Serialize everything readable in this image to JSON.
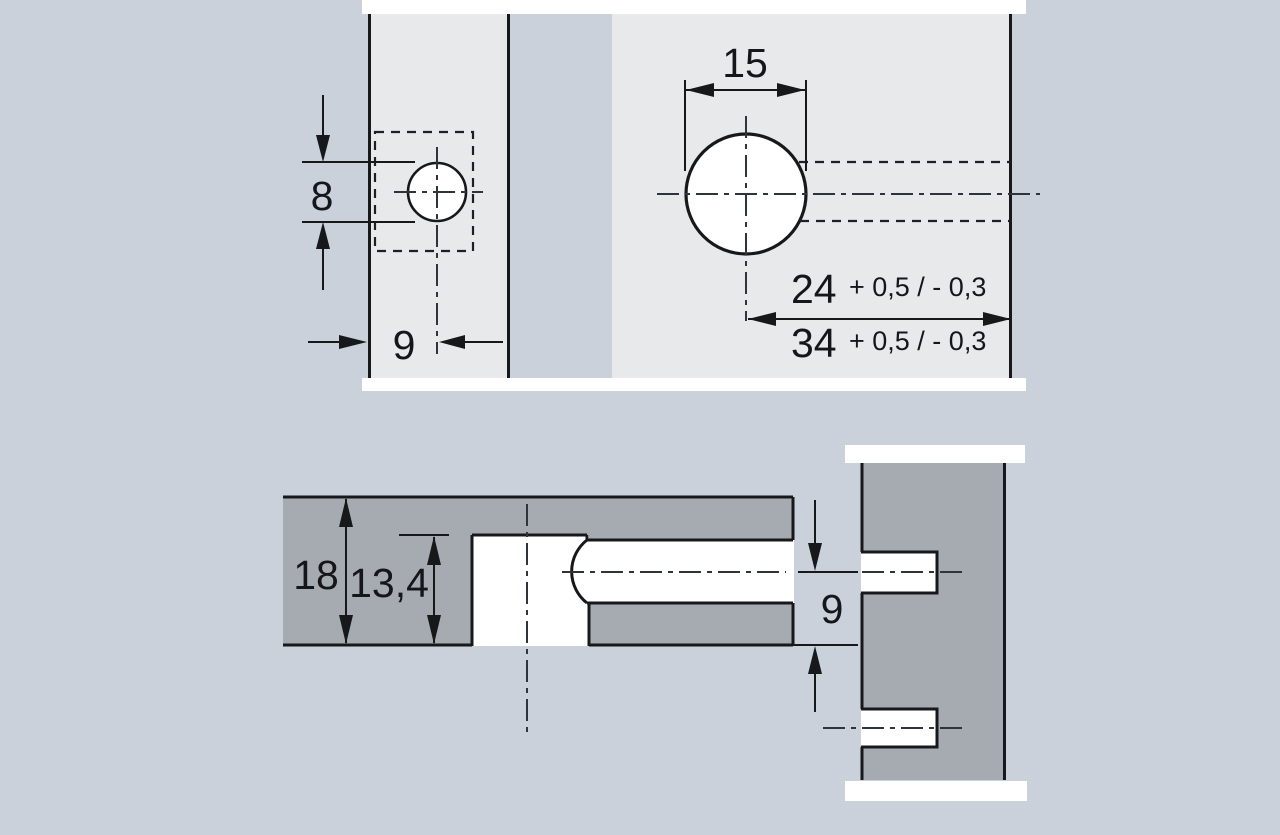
{
  "colors": {
    "background": "#cad1da",
    "panel_light": "#e8e9eb",
    "panel_dark": "#a6abb2",
    "outline": "#17181a",
    "hole_white": "#ffffff"
  },
  "top_view": {
    "edge_view": {
      "hole_diameter": "8",
      "edge_distance": "9"
    },
    "face_view": {
      "hole_diameter": "15",
      "depth_option_1": {
        "value": "24",
        "tolerance": "+ 0,5 / - 0,3"
      },
      "depth_option_2": {
        "value": "34",
        "tolerance": "+ 0,5 / - 0,3"
      }
    }
  },
  "section_view": {
    "panel_thickness": "18",
    "housing_depth": "13,4",
    "center_to_edge": "9"
  }
}
